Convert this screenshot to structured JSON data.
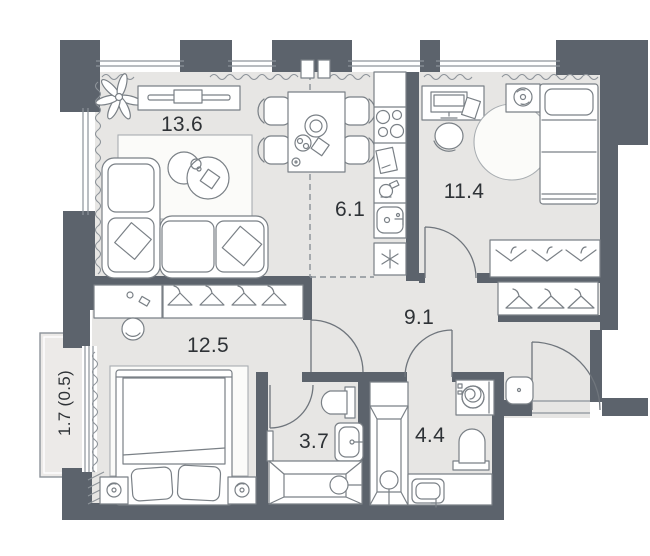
{
  "floor_plan": {
    "rooms": [
      {
        "id": "living-room",
        "label": "13.6"
      },
      {
        "id": "kitchen",
        "label": "6.1"
      },
      {
        "id": "bedroom",
        "label": "11.4"
      },
      {
        "id": "hallway",
        "label": "9.1"
      },
      {
        "id": "bedroom-2",
        "label": "12.5"
      },
      {
        "id": "bathroom",
        "label": "3.7"
      },
      {
        "id": "bathroom-2",
        "label": "4.4"
      },
      {
        "id": "balcony",
        "label": "1.7 (0.5)"
      }
    ],
    "colors": {
      "wall": "#5c636c",
      "floor": "#e7e6e4",
      "balcony_floor": "#eceae8",
      "furniture_outline": "#7a8086",
      "label_text": "#2e3236",
      "background": "#ffffff"
    }
  }
}
